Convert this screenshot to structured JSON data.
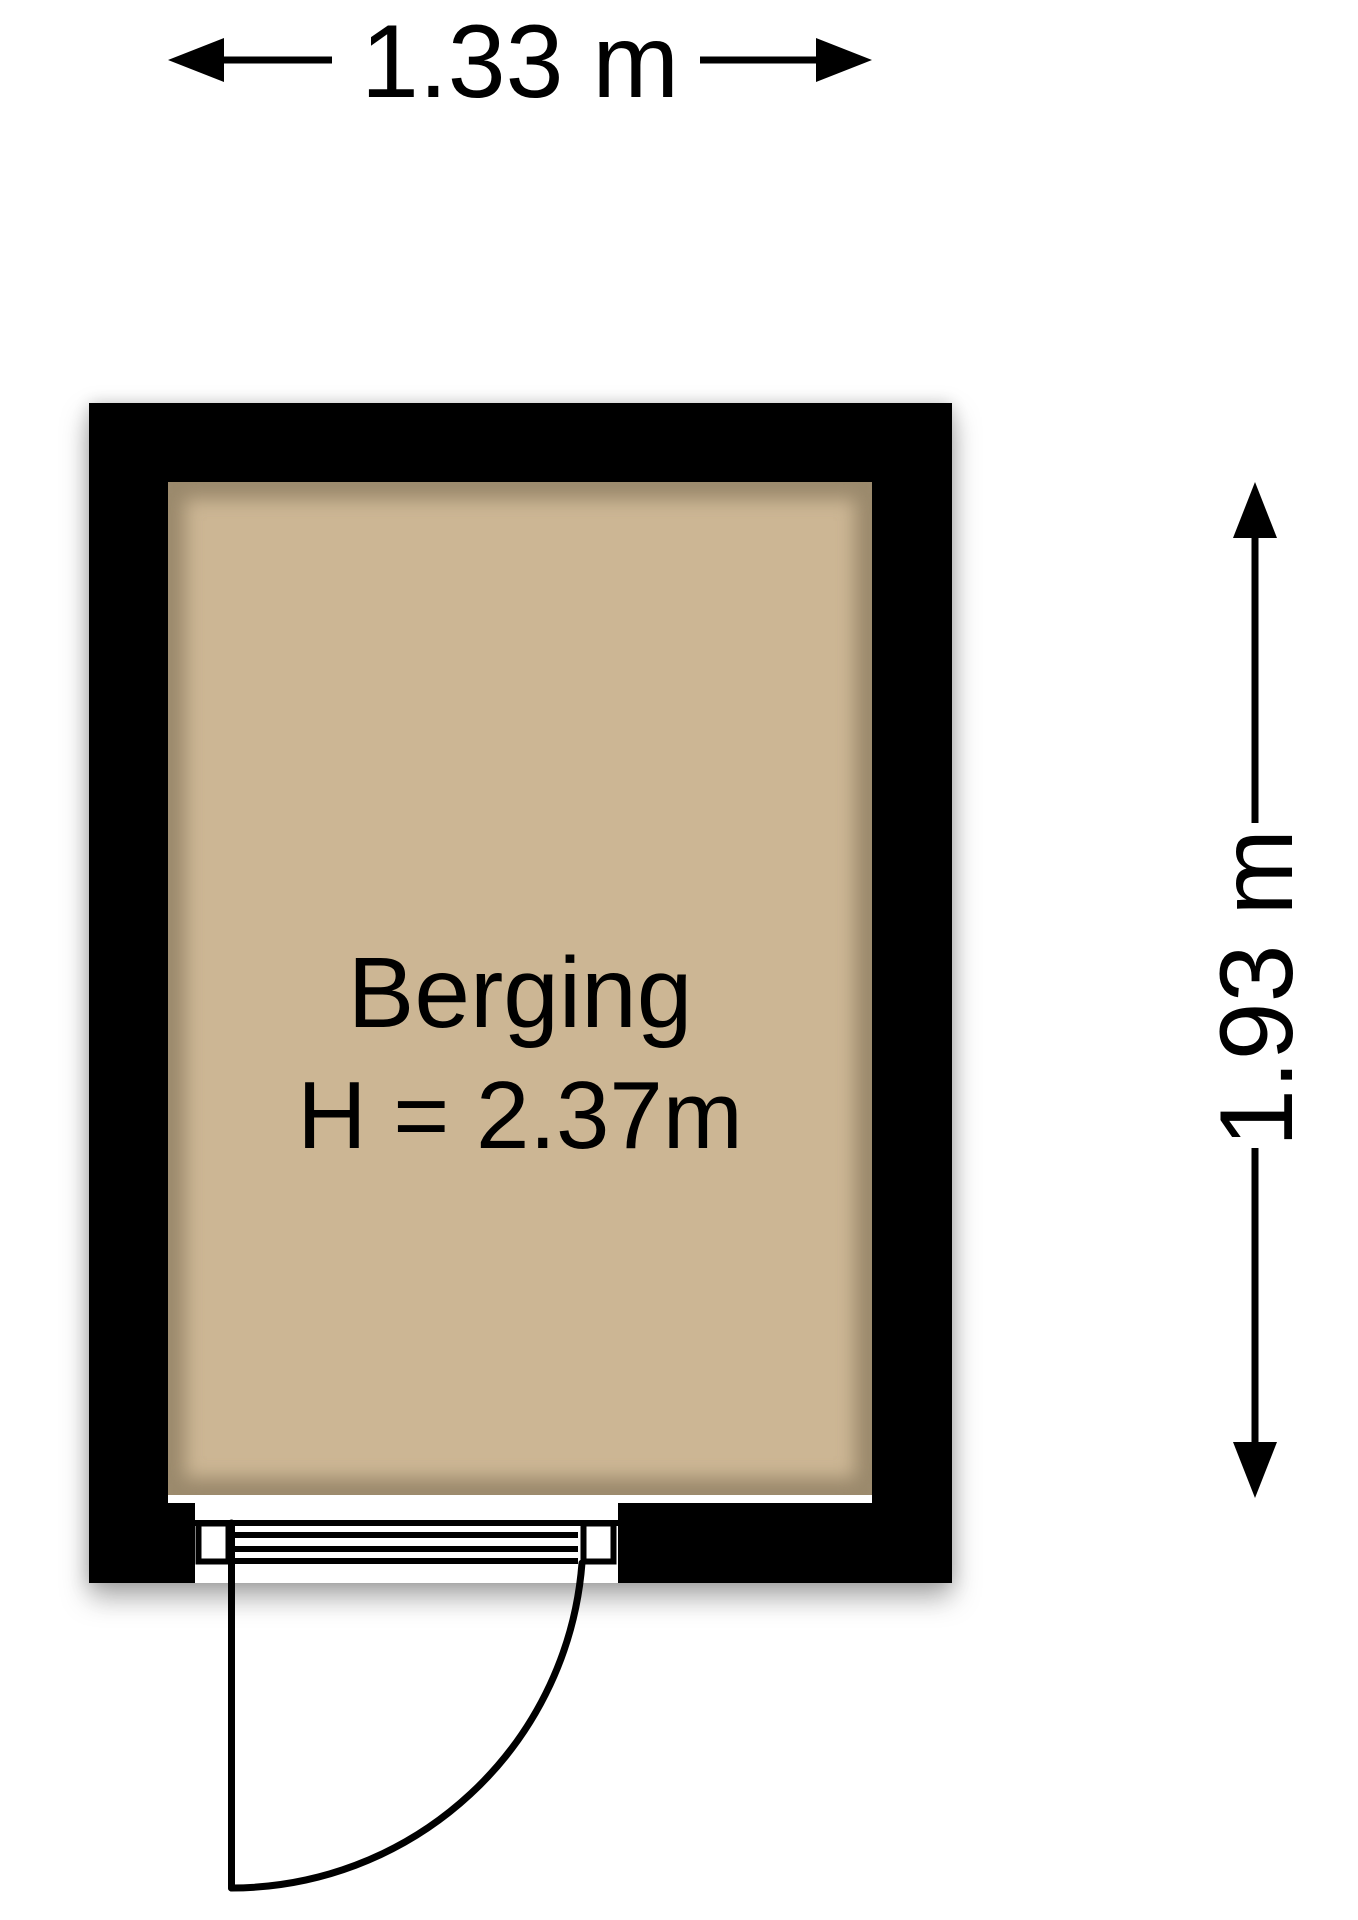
{
  "floorplan": {
    "room": {
      "name": "Berging",
      "ceiling_height_label": "H = 2.37m"
    },
    "dimensions": {
      "width_label": "1.33 m",
      "height_label": "1.93 m"
    },
    "colors": {
      "wall": "#000000",
      "floor": "#ccb694",
      "floor_shade": "#8e7e62",
      "background": "#ffffff",
      "ink": "#000000"
    }
  }
}
